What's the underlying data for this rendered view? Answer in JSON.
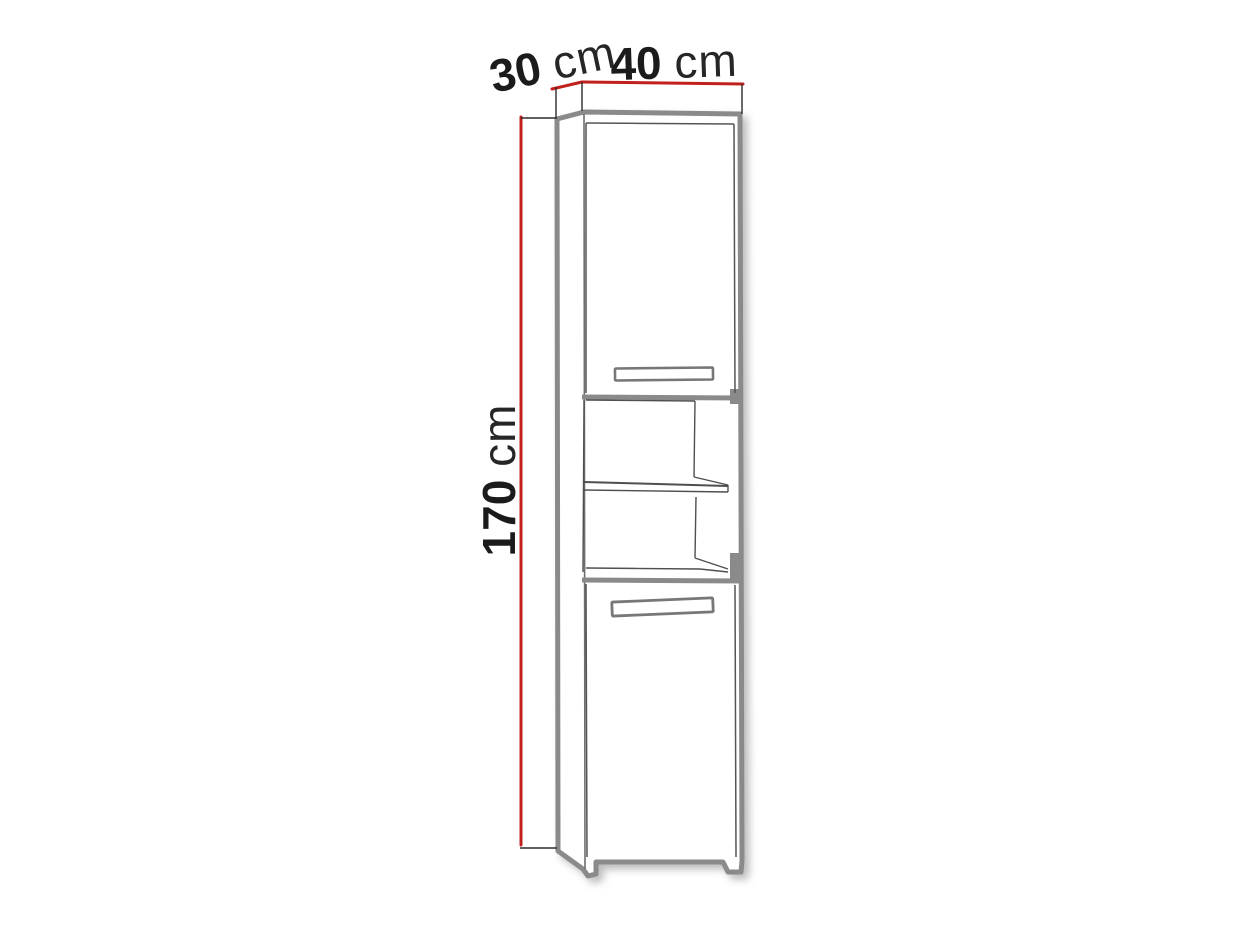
{
  "diagram": {
    "type": "furniture-dimension-drawing",
    "subject": "tall-two-door-cabinet-with-open-shelf",
    "dimensions": {
      "depth": {
        "value": "30",
        "unit": "cm"
      },
      "width": {
        "value": "40",
        "unit": "cm"
      },
      "height": {
        "value": "170",
        "unit": "cm"
      }
    },
    "colors": {
      "dimension_line": "#c1201c",
      "tick_line": "#2b2b2b",
      "cabinet_outline": "#8a8a8a",
      "detail_line": "#4f4f4f",
      "label_text": "#1b1b1b",
      "background": "#ffffff"
    }
  }
}
